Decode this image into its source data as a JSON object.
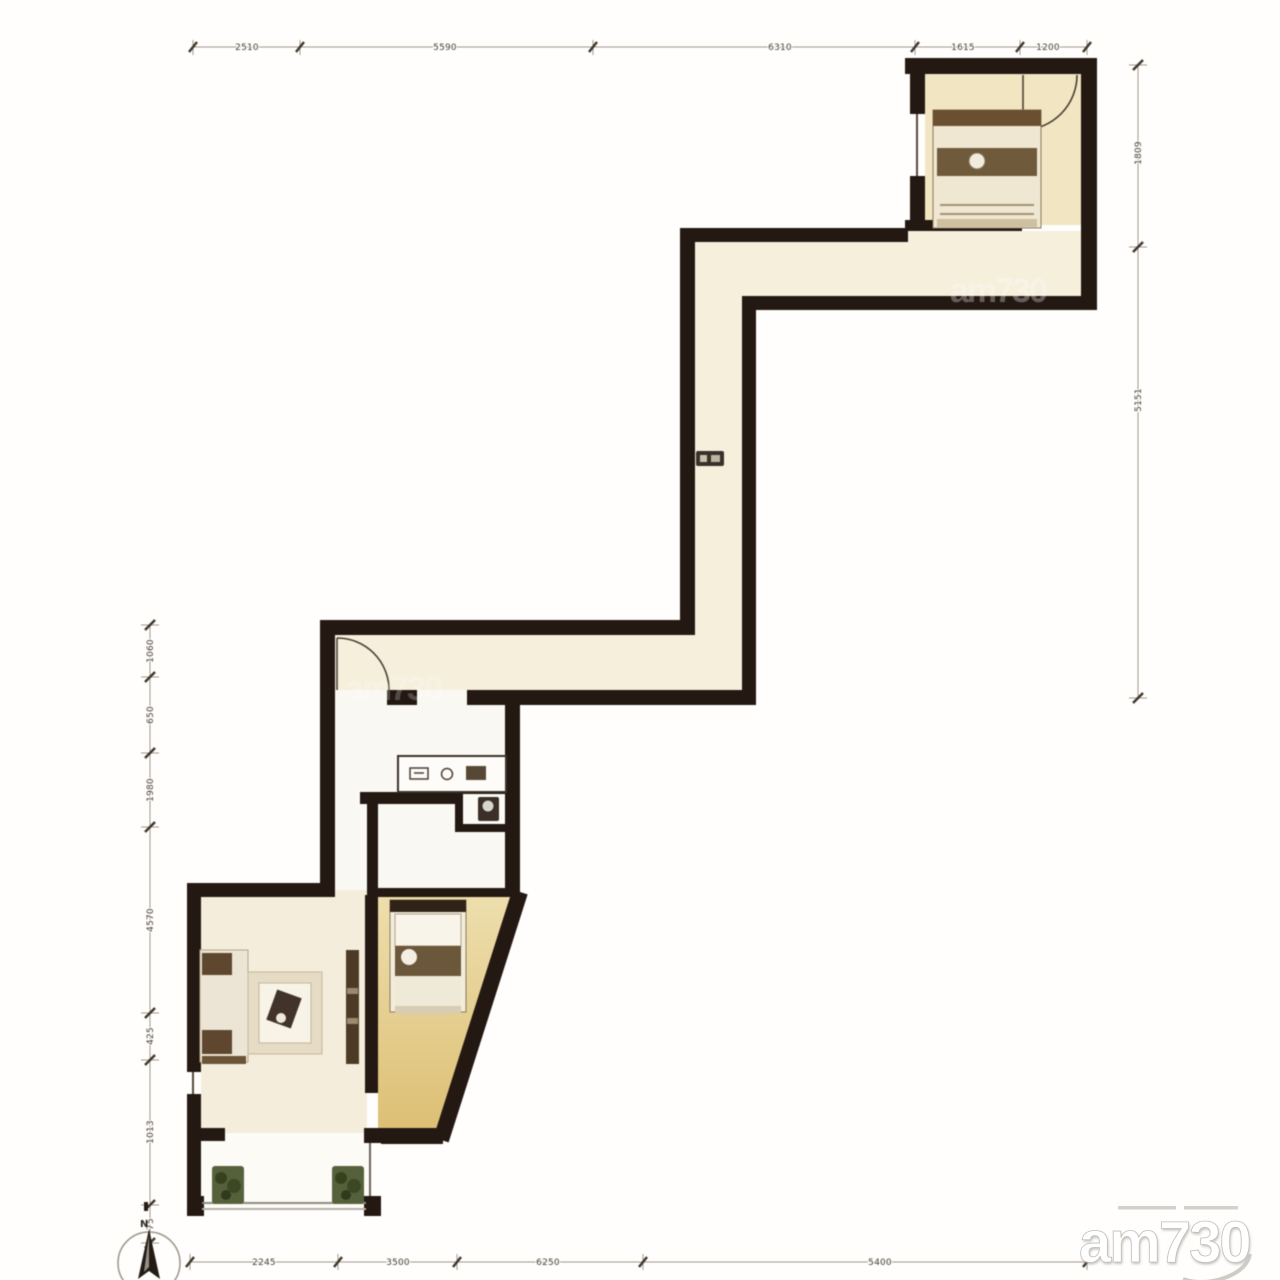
{
  "dimensions": {
    "top": [
      "2510",
      "5590",
      "6310",
      "1615",
      "1200"
    ],
    "right": [
      "1809",
      "5151"
    ],
    "left": [
      "1060",
      "650",
      "1980",
      "4570",
      "425",
      "1013",
      "75"
    ],
    "bottom": [
      "2245",
      "3500",
      "6250",
      "5400"
    ]
  },
  "compass": {
    "north_label": "N"
  },
  "watermark": {
    "brand": "am730"
  },
  "colors": {
    "wall": "#241812",
    "corridor_floor": "#f5efdc",
    "bedroom_floor_top": "#eedfae",
    "bedroom_floor_bottom": "#dcbe72",
    "living_floor": "#f5eddc",
    "room_floor": "#f2e6c2"
  }
}
